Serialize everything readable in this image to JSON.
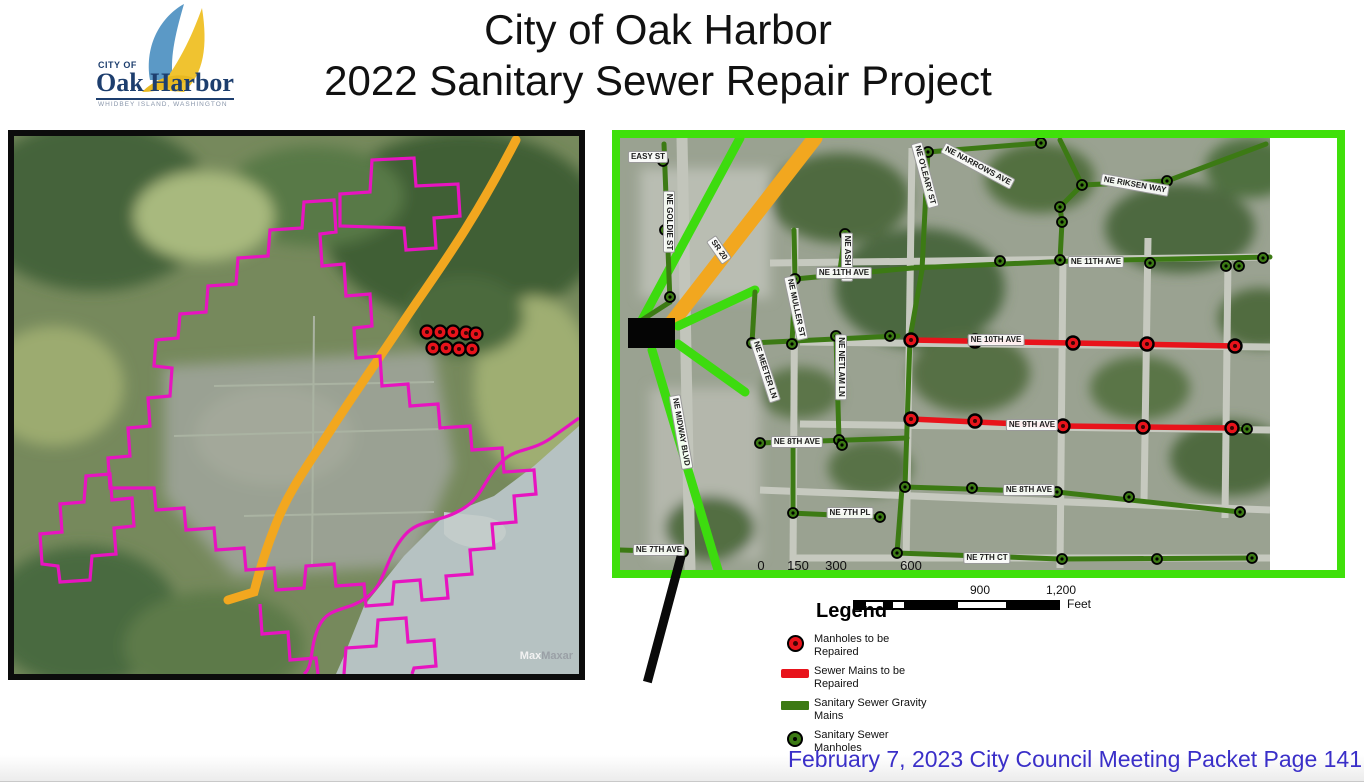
{
  "header": {
    "title_line1": "City of Oak Harbor",
    "title_line2": "2022 Sanitary Sewer Repair Project"
  },
  "logo": {
    "city_of": "CITY OF",
    "name": "Oak Harbor",
    "tagline": "WHIDBEY ISLAND, WASHINGTON"
  },
  "footer": {
    "text": "February 7, 2023 City Council Meeting Packet Page 141",
    "color": "#3a2fc8"
  },
  "scalebar": {
    "n900": "900",
    "n1200": "1,200",
    "unit": "Feet"
  },
  "legend": {
    "title": "Legend",
    "items": [
      {
        "symbol": "manhole-repair",
        "label": "Manholes to be Repaired"
      },
      {
        "symbol": "main-repair",
        "label": "Sewer Mains to be Repaired"
      },
      {
        "symbol": "gravity-main",
        "label": "Sanitary Sewer Gravity Mains"
      },
      {
        "symbol": "manhole",
        "label": "Sanitary Sewer Manholes"
      }
    ]
  },
  "overview_map": {
    "attribution_bold": "Max",
    "attribution_gray": "Maxar",
    "manhole_cluster": [
      [
        413,
        196
      ],
      [
        426,
        196
      ],
      [
        439,
        196
      ],
      [
        452,
        197
      ],
      [
        462,
        198
      ],
      [
        419,
        212
      ],
      [
        432,
        212
      ],
      [
        445,
        213
      ],
      [
        458,
        213
      ]
    ]
  },
  "detail_map": {
    "scale_numbers": [
      {
        "t": "0",
        "x": 141
      },
      {
        "t": "150",
        "x": 178
      },
      {
        "t": "300",
        "x": 216
      },
      {
        "t": "600",
        "x": 291
      }
    ],
    "labels": [
      {
        "t": "EASY ST",
        "x": 28,
        "y": 19,
        "r": 0
      },
      {
        "t": "NE GOLDIE ST",
        "x": 49,
        "y": 84,
        "r": 90
      },
      {
        "t": "SR 20",
        "x": 99,
        "y": 112,
        "r": 55
      },
      {
        "t": "NE O'LEARY ST",
        "x": 305,
        "y": 37,
        "r": 75
      },
      {
        "t": "NE NARROWS AVE",
        "x": 358,
        "y": 28,
        "r": 28
      },
      {
        "t": "NE RIKSEN WAY",
        "x": 515,
        "y": 47,
        "r": 10
      },
      {
        "t": "NE ASH LN",
        "x": 227,
        "y": 119,
        "r": 90
      },
      {
        "t": "NE 11TH AVE",
        "x": 224,
        "y": 135,
        "r": 0
      },
      {
        "t": "NE 11TH AVE",
        "x": 476,
        "y": 124,
        "r": 0
      },
      {
        "t": "NE MULLER ST",
        "x": 176,
        "y": 170,
        "r": 78
      },
      {
        "t": "NE MEETER LN",
        "x": 145,
        "y": 232,
        "r": 72
      },
      {
        "t": "NE NETLAM LN",
        "x": 221,
        "y": 229,
        "r": 90
      },
      {
        "t": "NE MIDWAY BLVD",
        "x": 61,
        "y": 294,
        "r": 80
      },
      {
        "t": "NE 10TH AVE",
        "x": 376,
        "y": 202,
        "r": 0
      },
      {
        "t": "NE 9TH AVE",
        "x": 412,
        "y": 287,
        "r": 0
      },
      {
        "t": "NE 8TH AVE",
        "x": 177,
        "y": 304,
        "r": 0
      },
      {
        "t": "NE 8TH AVE",
        "x": 409,
        "y": 352,
        "r": 0
      },
      {
        "t": "NE 7TH PL",
        "x": 230,
        "y": 375,
        "r": 0
      },
      {
        "t": "NE 7TH CT",
        "x": 367,
        "y": 420,
        "r": 0
      },
      {
        "t": "NE 7TH AVE",
        "x": 39,
        "y": 412,
        "r": 0
      }
    ],
    "lines": {
      "orange": [
        [
          195,
          0,
          40,
          200
        ]
      ],
      "bright": [
        [
          120,
          0,
          22,
          182
        ],
        [
          58,
          188,
          135,
          152
        ],
        [
          58,
          206,
          125,
          254
        ],
        [
          32,
          212,
          98,
          432
        ]
      ],
      "sewer": [
        [
          44,
          6,
          50,
          164
        ],
        [
          50,
          164,
          22,
          182
        ],
        [
          175,
          141,
          292,
          130
        ],
        [
          292,
          130,
          452,
          123
        ],
        [
          452,
          123,
          650,
          119
        ],
        [
          440,
          2,
          462,
          47
        ],
        [
          462,
          47,
          440,
          69
        ],
        [
          440,
          69,
          442,
          84
        ],
        [
          442,
          84,
          440,
          122
        ],
        [
          462,
          47,
          547,
          43
        ],
        [
          547,
          43,
          646,
          6
        ],
        [
          308,
          12,
          302,
          132
        ],
        [
          302,
          132,
          290,
          200
        ],
        [
          308,
          14,
          421,
          5
        ],
        [
          225,
          96,
          220,
          132
        ],
        [
          174,
          92,
          175,
          141
        ],
        [
          175,
          141,
          172,
          206
        ],
        [
          132,
          205,
          278,
          198
        ],
        [
          135,
          154,
          132,
          205
        ],
        [
          216,
          198,
          219,
          302
        ],
        [
          290,
          200,
          285,
          349
        ],
        [
          140,
          305,
          287,
          300
        ],
        [
          173,
          308,
          173,
          376
        ],
        [
          170,
          375,
          260,
          379
        ],
        [
          285,
          349,
          437,
          354
        ],
        [
          437,
          354,
          620,
          374
        ],
        [
          282,
          350,
          277,
          415
        ],
        [
          277,
          415,
          440,
          421
        ],
        [
          440,
          421,
          632,
          420
        ],
        [
          0,
          412,
          63,
          414
        ],
        [
          615,
          291,
          627,
          291
        ]
      ],
      "repair": [
        [
          291,
          202,
          453,
          205
        ],
        [
          453,
          205,
          615,
          208
        ],
        [
          291,
          281,
          443,
          288
        ],
        [
          443,
          288,
          612,
          290
        ]
      ]
    },
    "manholes": {
      "repair": [
        [
          291,
          202
        ],
        [
          355,
          203
        ],
        [
          453,
          205
        ],
        [
          527,
          206
        ],
        [
          615,
          208
        ],
        [
          291,
          281
        ],
        [
          355,
          283
        ],
        [
          443,
          288
        ],
        [
          523,
          289
        ],
        [
          612,
          290
        ]
      ],
      "sewer": [
        [
          43,
          23
        ],
        [
          45,
          92
        ],
        [
          50,
          159
        ],
        [
          175,
          141
        ],
        [
          235,
          135
        ],
        [
          380,
          123
        ],
        [
          440,
          122
        ],
        [
          530,
          125
        ],
        [
          606,
          128
        ],
        [
          619,
          128
        ],
        [
          643,
          120
        ],
        [
          462,
          47
        ],
        [
          440,
          69
        ],
        [
          442,
          84
        ],
        [
          547,
          43
        ],
        [
          308,
          14
        ],
        [
          421,
          5
        ],
        [
          132,
          205
        ],
        [
          172,
          206
        ],
        [
          270,
          198
        ],
        [
          216,
          198
        ],
        [
          219,
          302
        ],
        [
          140,
          305
        ],
        [
          222,
          307
        ],
        [
          285,
          349
        ],
        [
          352,
          350
        ],
        [
          437,
          354
        ],
        [
          509,
          359
        ],
        [
          620,
          374
        ],
        [
          173,
          375
        ],
        [
          260,
          379
        ],
        [
          277,
          415
        ],
        [
          442,
          421
        ],
        [
          537,
          421
        ],
        [
          632,
          420
        ],
        [
          63,
          414
        ],
        [
          627,
          291
        ],
        [
          225,
          96
        ]
      ]
    },
    "black_box": {
      "x": 8,
      "y": 180,
      "w": 47,
      "h": 30
    }
  },
  "colors": {
    "border_green": "#3fe00a",
    "bright_green": "#3ddb0f",
    "sewer_green": "#3c7a14",
    "repair_red": "#e8131b",
    "route_orange": "#f2a71f",
    "boundary_magenta": "#e714c0"
  }
}
